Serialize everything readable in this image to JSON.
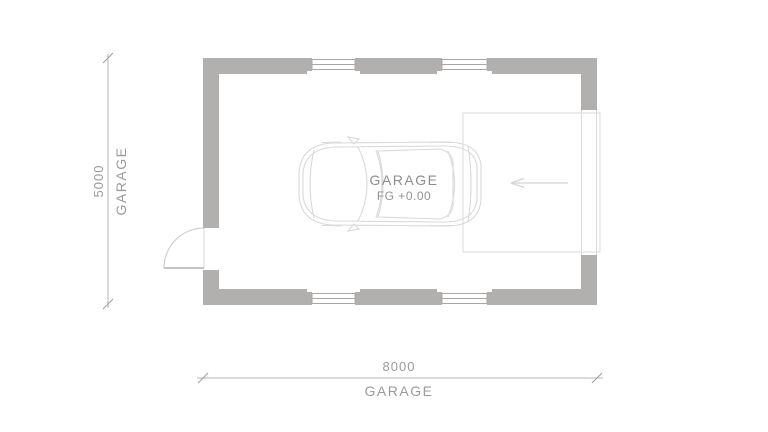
{
  "title": "Garage floor plan drawing",
  "plan": {
    "room_label": "GARAGE",
    "floor_level": "FG +0.00",
    "dimensions": {
      "width": {
        "value": "8000",
        "label": "GARAGE"
      },
      "height": {
        "value": "5000",
        "label": "GARAGE"
      }
    }
  },
  "icons": {
    "car": "car-top-view",
    "entry_arrow": "arrow-left",
    "door": "door-swing-quarter-circle",
    "windows": "double-line-window-symbol"
  },
  "colors": {
    "background": "#ffffff",
    "wall_fill": "#b2b0ae",
    "window_frame_line": "#a9a7a5",
    "dimension_line": "#b4b4b4",
    "dimension_text": "#9b9b9b",
    "room_text": "#8d8d8d",
    "car_line": "#d9d9d9",
    "apron_line": "#d9d9d9",
    "arrow_line": "#d4d4d4"
  }
}
